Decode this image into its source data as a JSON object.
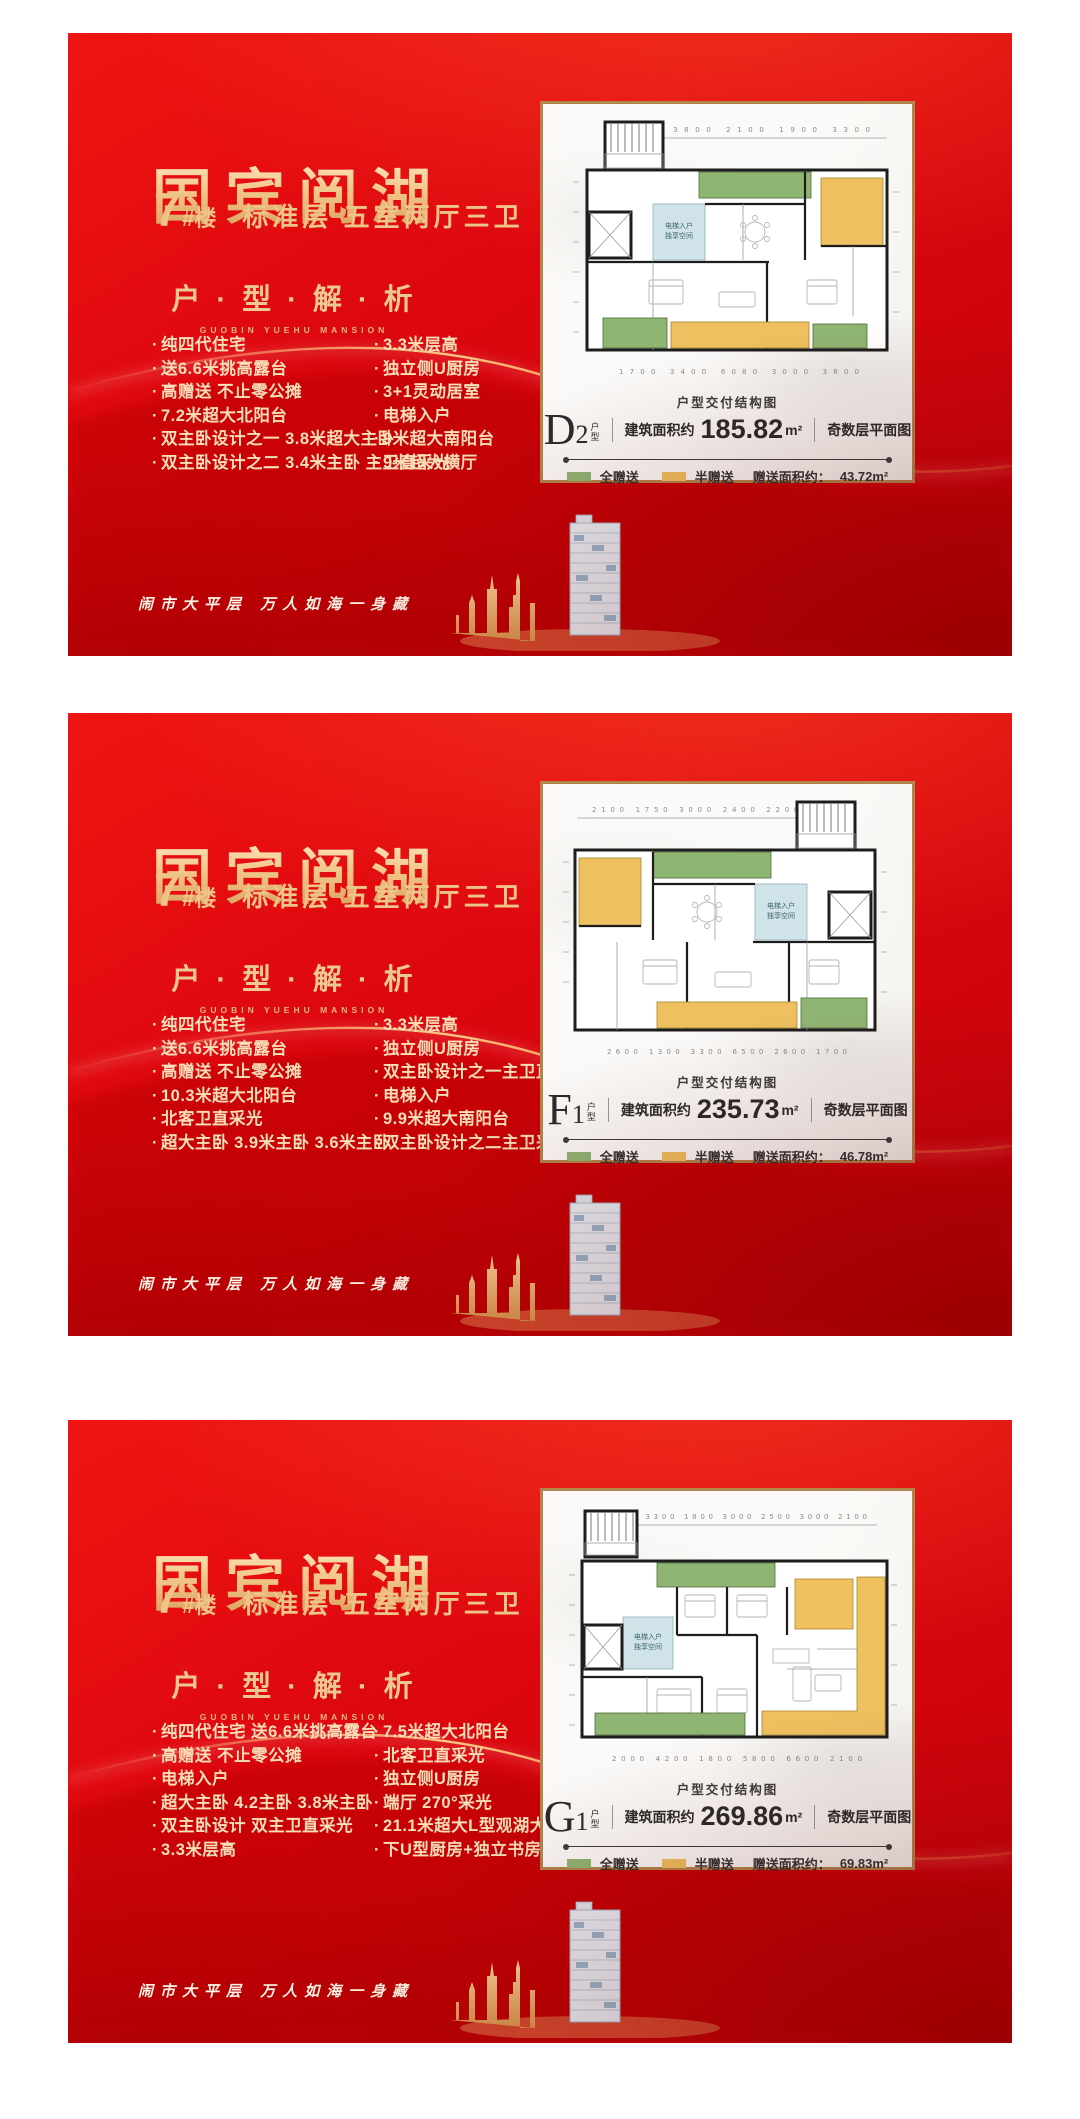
{
  "colors": {
    "green": "#8fb573",
    "yellow": "#eec05f",
    "blue": "#cfe3e8",
    "gold": "#b2854d"
  },
  "tagline": "闹市大平层  万人如海一身藏",
  "panels": [
    {
      "title": "国宾阅湖",
      "building_no": "7",
      "building_hash": "#楼",
      "subtitle": "标准层 五室两厅三卫",
      "section_title": "户 · 型 · 解 · 析",
      "section_sub": "GUOBIN YUEHU MANSION",
      "features_left": [
        "纯四代住宅",
        "送6.6米挑高露台",
        "高赠送 不止零公摊",
        "7.2米超大北阳台",
        "双主卧设计之一 3.8米超大主卧",
        "双主卧设计之二 3.4米主卧 主卫直采光"
      ],
      "features_right": [
        "3.3米层高",
        "独立侧U厨房",
        "3+1灵动居室",
        "电梯入户",
        "9米超大南阳台",
        "9米超大横厅"
      ],
      "card": {
        "caption": "户型交付结构图",
        "type_letter": "D",
        "type_digit": "2",
        "type_small_top": "户",
        "type_small_bottom": "型",
        "area_label": "建筑面积约",
        "area_value": "185.82",
        "area_unit": "m²",
        "floor_label": "奇数层平面图",
        "legend_full": "全赠送",
        "legend_half": "半赠送",
        "gift_label": "赠送面积约：",
        "gift_value": "43.72m²",
        "entry_line1": "电梯入户",
        "entry_line2": "独享空间",
        "dims_top": "1400   3800   2100   1900   3300",
        "dims_bottom": "1700   3400   6080   3000   3800"
      }
    },
    {
      "title": "国宾阅湖",
      "building_no": "7",
      "building_hash": "#楼",
      "subtitle": "标准层 五室两厅三卫",
      "section_title": "户 · 型 · 解 · 析",
      "section_sub": "GUOBIN YUEHU MANSION",
      "features_left": [
        "纯四代住宅",
        "送6.6米挑高露台",
        "高赠送 不止零公摊",
        "10.3米超大北阳台",
        "北客卫直采光",
        "超大主卧 3.9米主卧 3.6米主卧"
      ],
      "features_right": [
        "3.3米层高",
        "独立侧U厨房",
        "双主卧设计之一主卫直采光",
        "电梯入户",
        "9.9米超大南阳台",
        "双主卧设计之二主卫采光"
      ],
      "card": {
        "caption": "户型交付结构图",
        "type_letter": "F",
        "type_digit": "1",
        "type_small_top": "户",
        "type_small_bottom": "型",
        "area_label": "建筑面积约",
        "area_value": "235.73",
        "area_unit": "m²",
        "floor_label": "奇数层平面图",
        "legend_full": "全赠送",
        "legend_half": "半赠送",
        "gift_label": "赠送面积约：",
        "gift_value": "46.78m²",
        "entry_line1": "电梯入户",
        "entry_line2": "独享空间",
        "dims_top": "2100   1750   3000   2400   2200   1400",
        "dims_bottom": "2600   1300   3300   6500   2600   1700"
      }
    },
    {
      "title": "国宾阅湖",
      "building_no": "7",
      "building_hash": "#楼",
      "subtitle": "标准层 五室两厅三卫",
      "section_title": "户 · 型 · 解 · 析",
      "section_sub": "GUOBIN YUEHU MANSION",
      "features_left": [
        "纯四代住宅 送6.6米挑高露台",
        "高赠送 不止零公摊",
        "电梯入户",
        "超大主卧 4.2主卧 3.8米主卧",
        "双主卧设计 双主卫直采光",
        "3.3米层高"
      ],
      "features_right": [
        "7.5米超大北阳台",
        "北客卫直采光",
        "独立侧U厨房",
        "端厅 270°采光",
        "21.1米超大L型观湖大阳台",
        "下U型厨房+独立书房"
      ],
      "card": {
        "caption": "户型交付结构图",
        "type_letter": "G",
        "type_digit": "1",
        "type_small_top": "户",
        "type_small_bottom": "型",
        "area_label": "建筑面积约",
        "area_value": "269.86",
        "area_unit": "m²",
        "floor_label": "奇数层平面图",
        "legend_full": "全赠送",
        "legend_half": "半赠送",
        "gift_label": "赠送面积约：",
        "gift_value": "69.83m²",
        "entry_line1": "电梯入户",
        "entry_line2": "独享空间",
        "dims_top": "1400   3300   1800   3000   2500   3000   2100",
        "dims_bottom": "2000   4200   1800   5800   6600   2100"
      }
    }
  ]
}
